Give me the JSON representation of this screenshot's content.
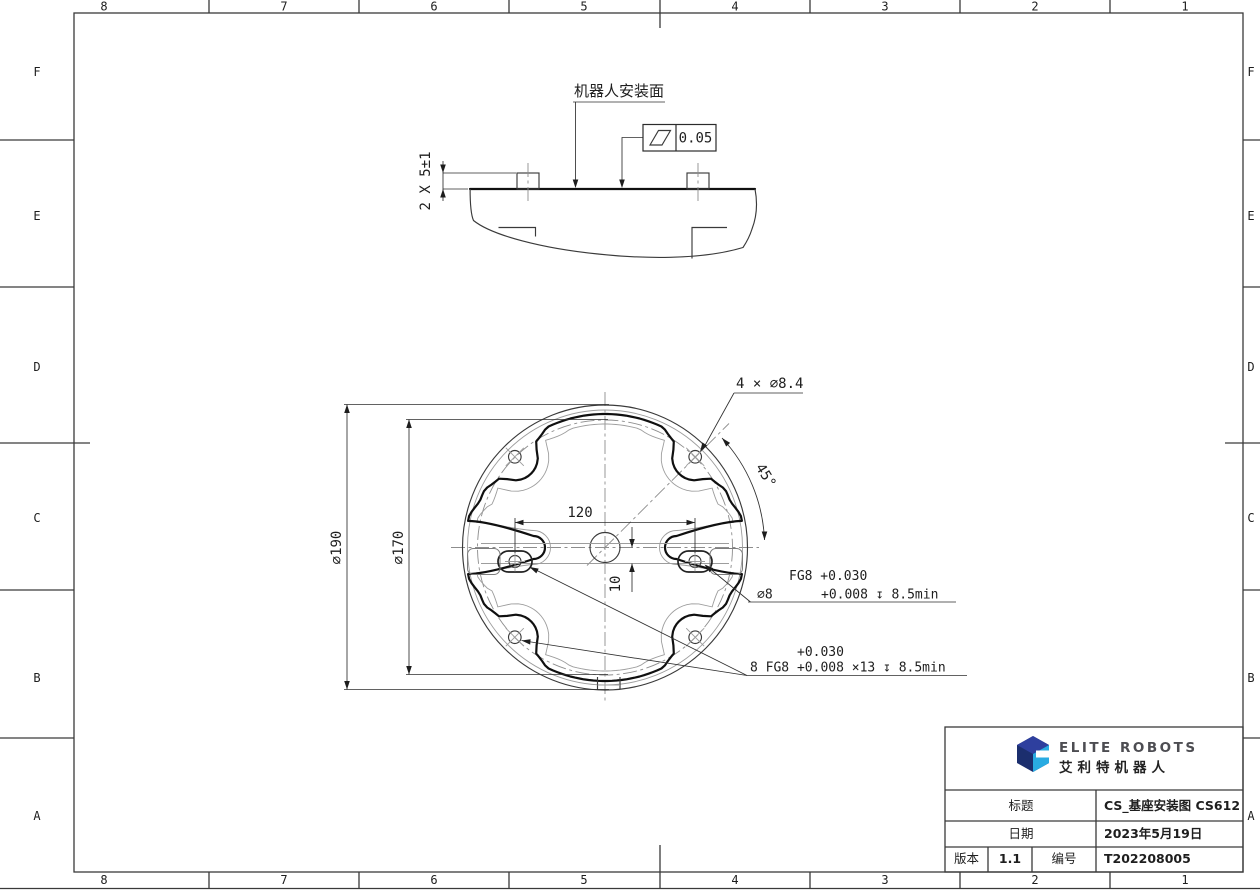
{
  "sheet": {
    "cols": [
      "8",
      "7",
      "6",
      "5",
      "4",
      "3",
      "2",
      "1"
    ],
    "rows": [
      "F",
      "E",
      "D",
      "C",
      "B",
      "A"
    ]
  },
  "side_view": {
    "surface_label": "机器人安装面",
    "flatness_value": "0.05",
    "pins_dim": "2 X 5±1"
  },
  "plan_view": {
    "dia_outer": "⌀190",
    "dia_bolt_circle": "⌀170",
    "pin_spacing": "120",
    "pin_offset": "10",
    "angle": "45°",
    "bolt_holes": "4 × ⌀8.4",
    "note_pin_hole": {
      "row1": "FG8 +0.030",
      "dia": "⌀8",
      "row2": "+0.008 ↧ 8.5min"
    },
    "note_fit_holes": {
      "row1": "+0.030",
      "row2": "8 FG8 +0.008 ×13 ↧ 8.5min"
    }
  },
  "title_block": {
    "brand_en": "ELITE ROBOTS",
    "brand_cn": "艾利特机器人",
    "title_label": "标题",
    "title_value": "CS_基座安装图 CS612",
    "date_label": "日期",
    "date_value": "2023年5月19日",
    "version_label": "版本",
    "version_value": "1.1",
    "number_label": "编号",
    "number_value": "T202208005"
  },
  "colors": {
    "logo_navy": "#1b2e6e",
    "logo_navy_light": "#2e3f9e",
    "logo_cyan": "#29abe2",
    "line_dark": "#101010"
  }
}
